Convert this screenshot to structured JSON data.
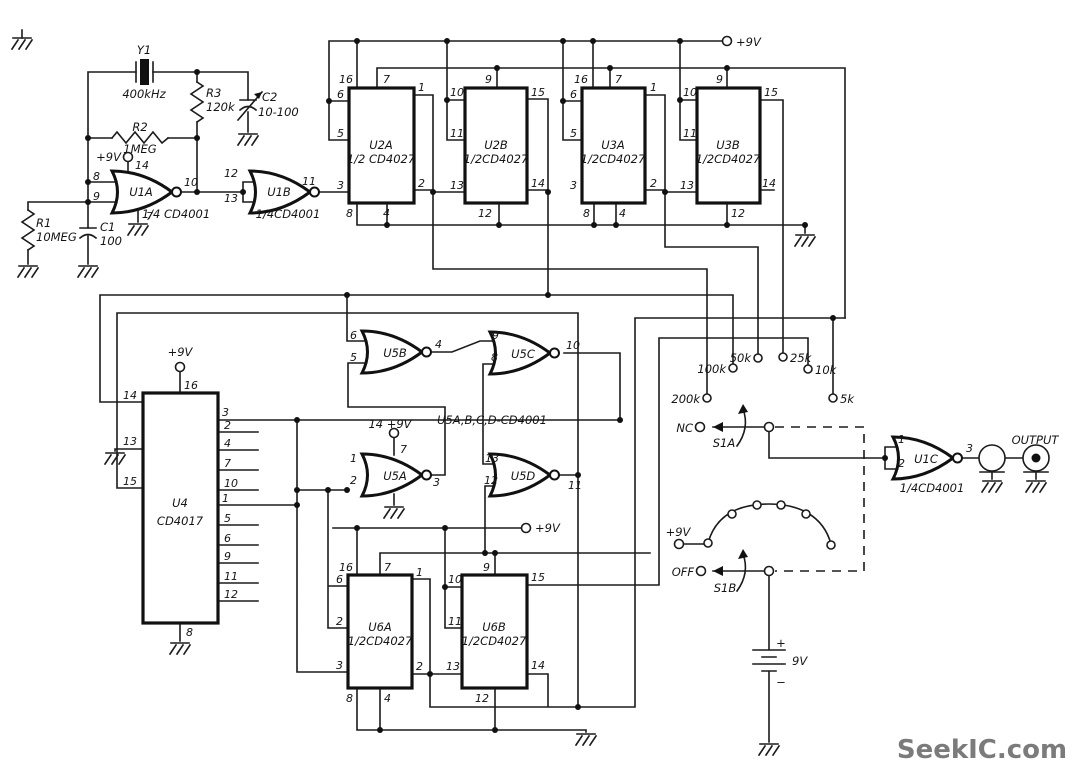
{
  "watermark": "SeekIC.com",
  "power": {
    "rail_top": "+9V",
    "u4_vdd": "+9V",
    "u5a_vdd": "14 +9V",
    "u6_rail": "+9V",
    "s1b_supply": "+9V",
    "battery_voltage": "9V",
    "battery_plus": "+",
    "battery_minus": "−"
  },
  "oscillator": {
    "y1": "Y1",
    "y1_value": "400kHz",
    "r3": "R3",
    "r3_value": "120k",
    "c2": "C2",
    "c2_value": "10-100",
    "r2": "R2",
    "r2_value": "1MEG",
    "r1": "R1",
    "r1_value": "10MEG",
    "c1": "C1",
    "c1_value": "100"
  },
  "u1a": {
    "name": "U1A",
    "part": "1/4 CD4001",
    "vdd_label": "+9V",
    "pin_vdd": "14",
    "pin_in1": "8",
    "pin_in2": "9",
    "pin_out": "10",
    "pin_gnd": "7"
  },
  "u1b": {
    "name": "U1B",
    "part": "1/4CD4001",
    "pin_in1": "12",
    "pin_in2": "13",
    "pin_out": "11"
  },
  "u1c": {
    "name": "U1C",
    "part": "1/4CD4001",
    "pin_in1": "1",
    "pin_in2": "2",
    "pin_out": "3"
  },
  "u2a": {
    "name": "U2A",
    "part": "1/2 CD4027",
    "pin16": "16",
    "pin7": "7",
    "pin6": "6",
    "pin5": "5",
    "pin3": "3",
    "pin1": "1",
    "pin2": "2",
    "pin8": "8",
    "pin4": "4"
  },
  "u2b": {
    "name": "U2B",
    "part": "1/2CD4027",
    "pin9": "9",
    "pin10": "10",
    "pin11": "11",
    "pin13": "13",
    "pin15": "15",
    "pin14": "14",
    "pin12": "12"
  },
  "u3a": {
    "name": "U3A",
    "part": "1/2CD4027",
    "pin16": "16",
    "pin7": "7",
    "pin6": "6",
    "pin5": "5",
    "pin3": "3",
    "pin1": "1",
    "pin2": "2",
    "pin8": "8",
    "pin4": "4"
  },
  "u3b": {
    "name": "U3B",
    "part": "1/2CD4027",
    "pin9": "9",
    "pin10": "10",
    "pin11": "11",
    "pin13": "13",
    "pin15": "15",
    "pin14": "14",
    "pin12": "12"
  },
  "u4": {
    "name": "U4",
    "part": "CD4017",
    "pin16": "16",
    "pin14": "14",
    "pin13": "13",
    "pin15": "15",
    "pin8": "8",
    "right_pins": [
      "3",
      "2",
      "4",
      "7",
      "10",
      "1",
      "5",
      "6",
      "9",
      "11",
      "12"
    ]
  },
  "u5": {
    "note": "U5A,B,C,D-CD4001",
    "u5a": {
      "name": "U5A",
      "pin_in1": "1",
      "pin_in2": "2",
      "pin_out": "3",
      "pin_vdd": "7"
    },
    "u5b": {
      "name": "U5B",
      "pin_in1": "6",
      "pin_in2": "5",
      "pin_out": "4"
    },
    "u5c": {
      "name": "U5C",
      "pin_in1": "9",
      "pin_in2": "8",
      "pin_out": "10"
    },
    "u5d": {
      "name": "U5D",
      "pin_in1": "13",
      "pin_in2": "12",
      "pin_out": "11"
    }
  },
  "u6a": {
    "name": "U6A",
    "part": "1/2CD4027",
    "pin16": "16",
    "pin7": "7",
    "pin6": "6",
    "pin2_left": "2",
    "pin3": "3",
    "pin1": "1",
    "pin2_right": "2",
    "pin8": "8",
    "pin4": "4"
  },
  "u6b": {
    "name": "U6B",
    "part": "1/2CD4027",
    "pin9": "9",
    "pin10": "10",
    "pin11": "11",
    "pin13": "13",
    "pin15": "15",
    "pin14": "14",
    "pin12": "12"
  },
  "s1a": {
    "name": "S1A",
    "nc": "NC",
    "taps": [
      "200k",
      "100k",
      "50k",
      "25k",
      "10k",
      "5k"
    ]
  },
  "s1b": {
    "name": "S1B",
    "off": "OFF"
  },
  "output": {
    "label": "OUTPUT"
  }
}
